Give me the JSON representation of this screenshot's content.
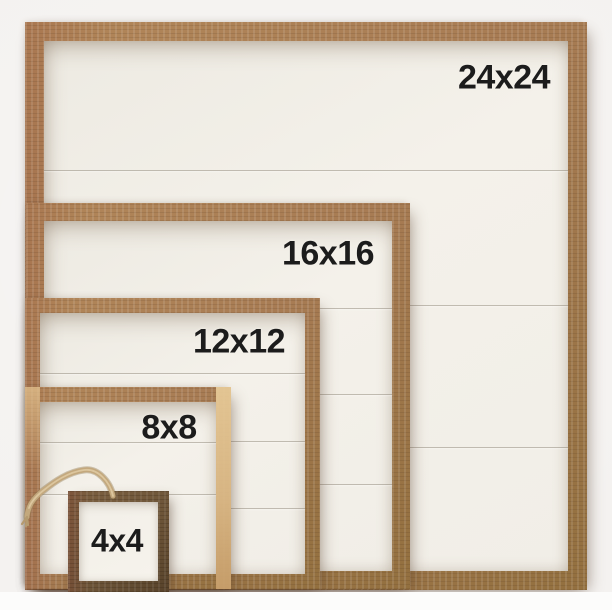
{
  "frames": [
    {
      "label": "24x24"
    },
    {
      "label": "16x16"
    },
    {
      "label": "12x12"
    },
    {
      "label": "8x8"
    },
    {
      "label": "4x4"
    }
  ],
  "colors": {
    "bg": "#f4f2f0",
    "wood": "#a87c54",
    "wood-dark": "#6e5639",
    "panel": "#f1eee7",
    "panel-small": "#f6f3ec",
    "label": "#1c1c1c",
    "twine": "#c3a87d",
    "plank-line": "#8a8274"
  }
}
